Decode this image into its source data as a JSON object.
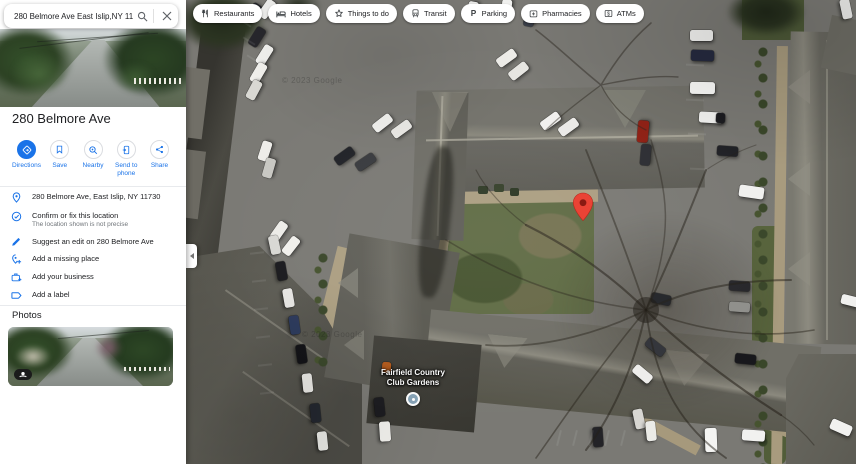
{
  "search": {
    "query": "280 Belmore Ave East Islip,NY 11730"
  },
  "chips": [
    {
      "label": "Restaurants"
    },
    {
      "label": "Hotels"
    },
    {
      "label": "Things to do"
    },
    {
      "label": "Transit"
    },
    {
      "label": "Parking"
    },
    {
      "label": "Pharmacies"
    },
    {
      "label": "ATMs"
    }
  ],
  "place": {
    "title": "280 Belmore Ave",
    "actions": [
      {
        "label": "Directions"
      },
      {
        "label": "Save"
      },
      {
        "label": "Nearby"
      },
      {
        "label": "Send to phone"
      },
      {
        "label": "Share"
      }
    ],
    "details": [
      {
        "label": "280 Belmore Ave, East Islip, NY 11730"
      },
      {
        "label": "Confirm or fix this location",
        "sublabel": "The location shown is not precise"
      },
      {
        "label": "Suggest an edit on 280 Belmore Ave"
      },
      {
        "label": "Add a missing place"
      },
      {
        "label": "Add your business"
      },
      {
        "label": "Add a label"
      }
    ],
    "photos_heading": "Photos"
  },
  "map": {
    "poi_label_line1": "Fairfield Country",
    "poi_label_line2": "Club Gardens",
    "watermark": "© 2023 Google",
    "pin_color": "#EA4335"
  },
  "colors": {
    "accent": "#1a73e8"
  }
}
